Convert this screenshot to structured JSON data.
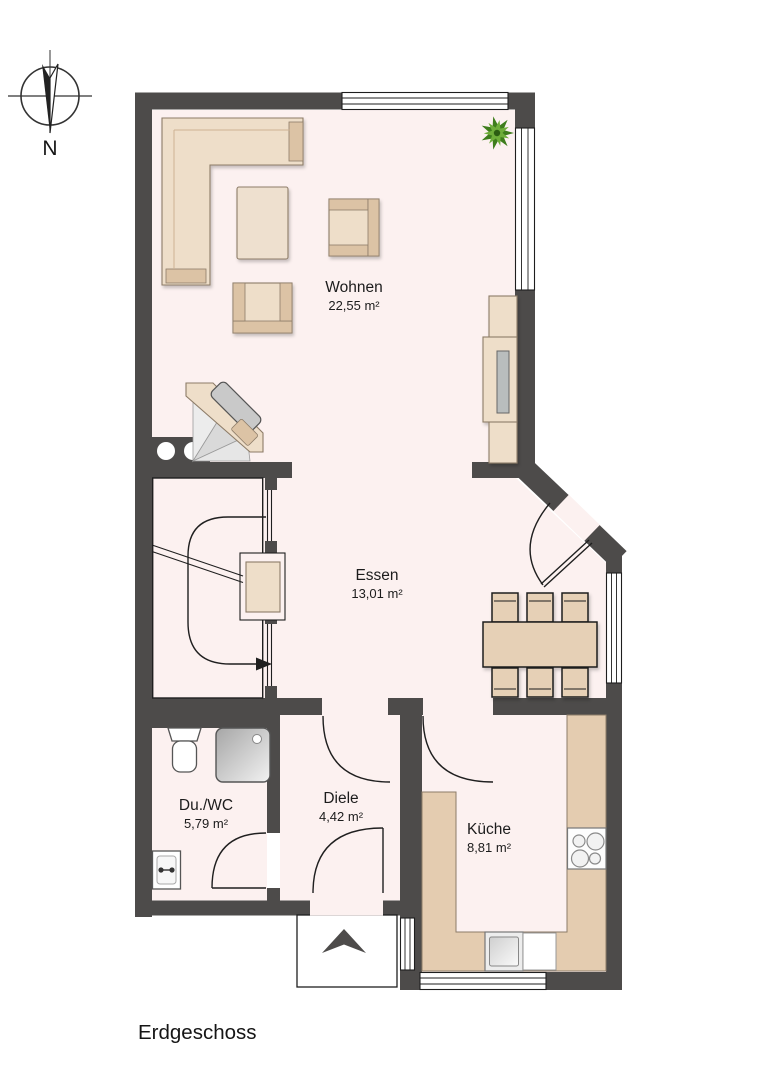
{
  "document": {
    "title": "Erdgeschoss"
  },
  "compass": {
    "label": "N"
  },
  "rooms": [
    {
      "id": "wohnen",
      "name": "Wohnen",
      "area": "22,55 m²"
    },
    {
      "id": "essen",
      "name": "Essen",
      "area": "13,01 m²"
    },
    {
      "id": "duwc",
      "name": "Du./WC",
      "area": "5,79 m²"
    },
    {
      "id": "diele",
      "name": "Diele",
      "area": "4,42 m²"
    },
    {
      "id": "kueche",
      "name": "Küche",
      "area": "8,81 m²"
    }
  ],
  "colors": {
    "wall": "#4d4b4a",
    "floor": "#fcf1f0",
    "furn": "#eedec9",
    "furnDark": "#dcc3a5",
    "furnEdge": "#8d7c68",
    "counter": "#e4ccb0",
    "line": "#1f1f1f",
    "plant": "#3e7d1c"
  }
}
